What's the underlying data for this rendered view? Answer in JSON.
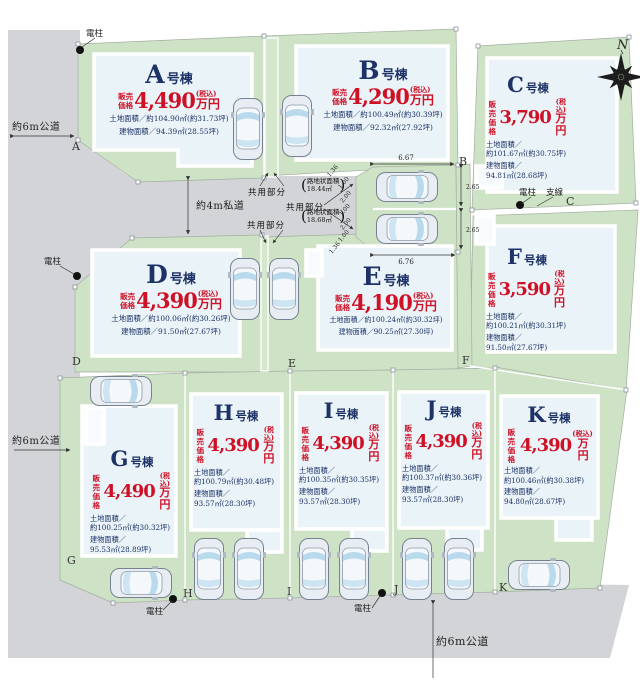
{
  "map": {
    "compass_n": "N",
    "roads": {
      "top_left": "約6m公道",
      "private": "約4m私道",
      "left": "約6m公道",
      "bottom": "約6m公道"
    },
    "pole_label": "電柱",
    "wire_label": "支線",
    "common": {
      "label": "共用部分",
      "paren_open": "(",
      "paren_close": ")",
      "roji1_line1": "路地状面積",
      "roji1_line2": "18.44㎡",
      "roji2_line1": "路地状面積",
      "roji2_line2": "18.68㎡"
    },
    "dims": {
      "top": "6.67",
      "bottom": "6.76",
      "right_upper": "2.65",
      "right_lower": "2.65",
      "diag_top": "1.36",
      "diag_bottom": "1.36",
      "stack": [
        "1.00",
        "2.00",
        "1.00",
        "2.00",
        "1.00"
      ]
    }
  },
  "price_prefix_1": "販売",
  "price_prefix_2": "価格",
  "price_unit": "万円",
  "tax_note": "(税込)",
  "unit_suffix": "号棟",
  "corners": [
    "A",
    "B",
    "C",
    "D",
    "E",
    "F",
    "G",
    "H",
    "I",
    "J",
    "K"
  ],
  "lots": [
    {
      "id": "A",
      "price": "4,490",
      "land_label": "土地面積／",
      "land_value": "約104.90㎡(約31.73坪)",
      "building_label": "建物面積／",
      "building_value": "94.39㎡(28.55坪)"
    },
    {
      "id": "B",
      "price": "4,290",
      "land_label": "土地面積／",
      "land_value": "約100.49㎡(約30.39坪)",
      "building_label": "建物面積／",
      "building_value": "92.32㎡(27.92坪)"
    },
    {
      "id": "C",
      "price": "3,790",
      "land_label": "土地面積／",
      "land_value": "約101.67㎡(約30.75坪)",
      "building_label": "建物面積／",
      "building_value": "94.81㎡(28.68坪)"
    },
    {
      "id": "D",
      "price": "4,390",
      "land_label": "土地面積／",
      "land_value": "約100.06㎡(約30.26坪)",
      "building_label": "建物面積／",
      "building_value": "91.50㎡(27.67坪)"
    },
    {
      "id": "E",
      "price": "4,190",
      "land_label": "土地面積／",
      "land_value": "約100.24㎡(約30.32坪)",
      "building_label": "建物面積／",
      "building_value": "90.25㎡(27.30坪)"
    },
    {
      "id": "F",
      "price": "3,590",
      "land_label": "土地面積／",
      "land_value": "約100.21㎡(約30.31坪)",
      "building_label": "建物面積／",
      "building_value": "91.50㎡(27.67坪)"
    },
    {
      "id": "G",
      "price": "4,490",
      "land_label": "土地面積／",
      "land_value": "約100.25㎡(約30.32坪)",
      "building_label": "建物面積／",
      "building_value": "95.53㎡(28.89坪)"
    },
    {
      "id": "H",
      "price": "4,390",
      "land_label": "土地面積／",
      "land_value": "約100.79㎡(約30.48坪)",
      "building_label": "建物面積／",
      "building_value": "93.57㎡(28.30坪)"
    },
    {
      "id": "I",
      "price": "4,390",
      "land_label": "土地面積／",
      "land_value": "約100.35㎡(約30.35坪)",
      "building_label": "建物面積／",
      "building_value": "93.57㎡(28.30坪)"
    },
    {
      "id": "J",
      "price": "4,390",
      "land_label": "土地面積／",
      "land_value": "約100.37㎡(約30.36坪)",
      "building_label": "建物面積／",
      "building_value": "93.57㎡(28.30坪)"
    },
    {
      "id": "K",
      "price": "4,390",
      "land_label": "土地面積／",
      "land_value": "約100.46㎡(約30.38坪)",
      "building_label": "建物面積／",
      "building_value": "94.80㎡(28.67坪)"
    }
  ]
}
